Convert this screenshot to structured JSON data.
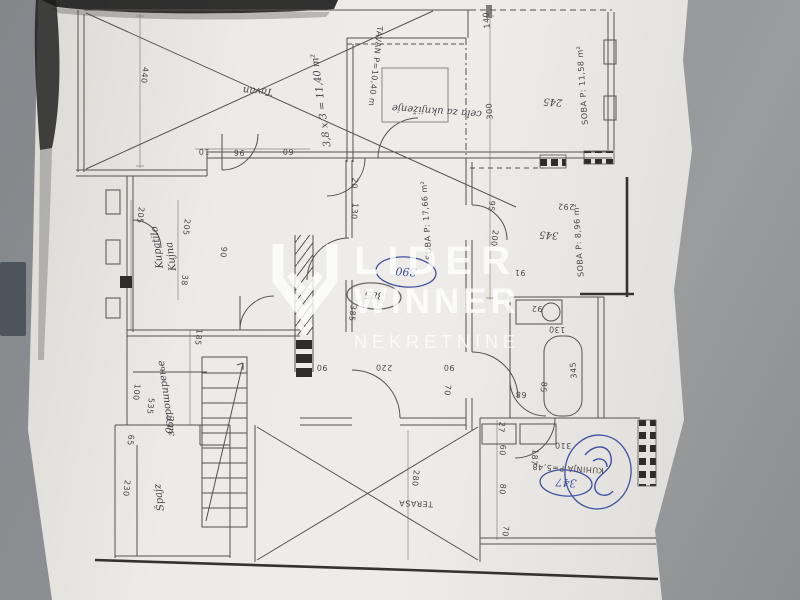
{
  "watermark": {
    "line1": "LIDER",
    "line2": "WINNER",
    "line3": "NEKRETNINE",
    "color": "#ffffff",
    "logo": "shield-chevron-icon"
  },
  "photo": {
    "background_color": "#8f9193",
    "paper_color": "#edebe7",
    "ink_color": "#4b4a45",
    "pen_color": "#3f51a2"
  },
  "plan": {
    "labels": [
      {
        "n": "dim-440",
        "t": "440",
        "x": 142,
        "y": 75,
        "r": 96,
        "cls": "d"
      },
      {
        "n": "hand-tavan",
        "t": "Tavan",
        "x": 258,
        "y": 88,
        "r": 184,
        "cls": "h",
        "s": 14
      },
      {
        "n": "hand-area-note",
        "t": "3,8 x 3 = 11,40 m²",
        "x": 324,
        "y": 100,
        "r": -98,
        "cls": "h",
        "s": 9
      },
      {
        "n": "room-tavan-label",
        "t": "TAVAN P=10,40 m",
        "x": 373,
        "y": 66,
        "r": 96,
        "cls": "d"
      },
      {
        "n": "dim-10",
        "t": "10",
        "x": 204,
        "y": 149,
        "r": 182,
        "cls": "d"
      },
      {
        "n": "dim-96",
        "t": "96",
        "x": 239,
        "y": 150,
        "r": 182,
        "cls": "d"
      },
      {
        "n": "dim-60a",
        "t": "60",
        "x": 288,
        "y": 149,
        "r": 182,
        "cls": "d"
      },
      {
        "n": "dim-140",
        "t": "140",
        "x": 489,
        "y": 20,
        "r": -94,
        "cls": "d"
      },
      {
        "n": "room-soba-1158",
        "t": "SOBA P: 11,58 m²",
        "x": 585,
        "y": 85,
        "r": -94,
        "cls": "d",
        "s": 8.5
      },
      {
        "n": "hand-uknjizenje",
        "t": "cela za uknjiženje",
        "x": 437,
        "y": 108,
        "r": 184,
        "cls": "h",
        "s": 11
      },
      {
        "n": "dim-300",
        "t": "300",
        "x": 492,
        "y": 111,
        "r": -94,
        "cls": "d"
      },
      {
        "n": "hand-245",
        "t": "245",
        "x": 553,
        "y": 99,
        "r": 184,
        "cls": "h",
        "s": 9
      },
      {
        "n": "dim-205a",
        "t": "205",
        "x": 138,
        "y": 215,
        "r": 96,
        "cls": "d"
      },
      {
        "n": "dim-205b",
        "t": "205",
        "x": 184,
        "y": 227,
        "r": 96,
        "cls": "d"
      },
      {
        "n": "dim-38",
        "t": "38",
        "x": 182,
        "y": 280,
        "r": 96,
        "cls": "d"
      },
      {
        "n": "dim-90a",
        "t": "90",
        "x": 221,
        "y": 252,
        "r": 96,
        "cls": "d"
      },
      {
        "n": "hand-kupatilo",
        "t": "Kupatilo",
        "x": 160,
        "y": 247,
        "r": -98,
        "cls": "h",
        "s": 9
      },
      {
        "n": "hand-kujna",
        "t": "Kujna",
        "x": 174,
        "y": 256,
        "r": -98,
        "cls": "h",
        "s": 9
      },
      {
        "n": "dim-20",
        "t": "20",
        "x": 352,
        "y": 183,
        "r": 96,
        "cls": "d"
      },
      {
        "n": "dim-130a",
        "t": "130",
        "x": 352,
        "y": 211,
        "r": 96,
        "cls": "d"
      },
      {
        "n": "dim-385",
        "t": "385",
        "x": 350,
        "y": 313,
        "r": 96,
        "cls": "d"
      },
      {
        "n": "room-soba-1766",
        "t": "SOBA P: 17,66 m²",
        "x": 429,
        "y": 220,
        "r": -94,
        "cls": "d",
        "s": 8.5
      },
      {
        "n": "dim-292",
        "t": "292",
        "x": 566,
        "y": 204,
        "r": 182,
        "cls": "d"
      },
      {
        "n": "dim-95",
        "t": "95",
        "x": 489,
        "y": 206,
        "r": 96,
        "cls": "d"
      },
      {
        "n": "dim-200",
        "t": "200",
        "x": 492,
        "y": 238,
        "r": 96,
        "cls": "d"
      },
      {
        "n": "room-soba-896",
        "t": "SOBA P: 8,96 m²",
        "x": 581,
        "y": 240,
        "r": -94,
        "cls": "d",
        "s": 8.5
      },
      {
        "n": "hand-345a",
        "t": "345",
        "x": 549,
        "y": 232,
        "r": 184,
        "cls": "h",
        "s": 9
      },
      {
        "n": "dim-91",
        "t": "91",
        "x": 520,
        "y": 270,
        "r": 182,
        "cls": "d"
      },
      {
        "n": "dim-92",
        "t": "92",
        "x": 537,
        "y": 306,
        "r": 182,
        "cls": "d"
      },
      {
        "n": "dim-130b",
        "t": "130",
        "x": 557,
        "y": 327,
        "r": 182,
        "cls": "d"
      },
      {
        "n": "dim-345b",
        "t": "345",
        "x": 576,
        "y": 370,
        "r": -94,
        "cls": "d"
      },
      {
        "n": "dim-85",
        "t": "85",
        "x": 541,
        "y": 387,
        "r": 96,
        "cls": "d"
      },
      {
        "n": "dim-68",
        "t": "68",
        "x": 521,
        "y": 392,
        "r": 182,
        "cls": "d"
      },
      {
        "n": "dim-185",
        "t": "185",
        "x": 196,
        "y": 337,
        "r": 96,
        "cls": "d"
      },
      {
        "n": "dim-100",
        "t": "100",
        "x": 134,
        "y": 392,
        "r": 96,
        "cls": "d"
      },
      {
        "n": "dim-535",
        "t": "535",
        "x": 148,
        "y": 406,
        "r": 96,
        "cls": "d"
      },
      {
        "n": "hand-prosirenje",
        "t": "за проширење",
        "x": 169,
        "y": 398,
        "r": -98,
        "cls": "h",
        "s": 9
      },
      {
        "n": "hand-390",
        "t": "390",
        "x": 166,
        "y": 424,
        "r": 96,
        "cls": "h",
        "s": 9
      },
      {
        "n": "hand-spajz",
        "t": "Špajz",
        "x": 162,
        "y": 497,
        "r": -98,
        "cls": "h",
        "s": 12
      },
      {
        "n": "dim-230",
        "t": "230",
        "x": 124,
        "y": 488,
        "r": 96,
        "cls": "d"
      },
      {
        "n": "dim-65",
        "t": "65",
        "x": 128,
        "y": 440,
        "r": 96,
        "cls": "d"
      },
      {
        "n": "room-terasa",
        "t": "TERASA",
        "x": 416,
        "y": 501,
        "r": 182,
        "cls": "d",
        "s": 9.5
      },
      {
        "n": "dim-280",
        "t": "280",
        "x": 413,
        "y": 478,
        "r": 96,
        "cls": "d"
      },
      {
        "n": "dim-220",
        "t": "220",
        "x": 384,
        "y": 365,
        "r": 182,
        "cls": "d"
      },
      {
        "n": "dim-90b",
        "t": "90",
        "x": 322,
        "y": 365,
        "r": 182,
        "cls": "d"
      },
      {
        "n": "dim-90c",
        "t": "90",
        "x": 449,
        "y": 365,
        "r": 182,
        "cls": "d"
      },
      {
        "n": "dim-70a",
        "t": "70",
        "x": 445,
        "y": 390,
        "r": 96,
        "cls": "d"
      },
      {
        "n": "room-kuhinja",
        "t": "KUHINJA P=5,48",
        "x": 568,
        "y": 466,
        "r": 183,
        "cls": "d",
        "s": 8.5
      },
      {
        "n": "dim-187",
        "t": "187",
        "x": 532,
        "y": 457,
        "r": 96,
        "cls": "d"
      },
      {
        "n": "dim-60b",
        "t": "60",
        "x": 500,
        "y": 450,
        "r": 96,
        "cls": "d"
      },
      {
        "n": "dim-27",
        "t": "27",
        "x": 499,
        "y": 427,
        "r": 96,
        "cls": "d"
      },
      {
        "n": "dim-80",
        "t": "80",
        "x": 500,
        "y": 489,
        "r": 96,
        "cls": "d"
      },
      {
        "n": "dim-70b",
        "t": "70",
        "x": 503,
        "y": 531,
        "r": 96,
        "cls": "d"
      },
      {
        "n": "dim-310",
        "t": "310",
        "x": 563,
        "y": 443,
        "r": 182,
        "cls": "d"
      }
    ],
    "circled": [
      {
        "n": "circled-390-blue-pen",
        "t": "390",
        "x": 406,
        "y": 272,
        "r": 184,
        "rx": 30,
        "ry": 15,
        "cls": "hb"
      },
      {
        "n": "circled-385-pencil",
        "t": "385",
        "x": 374,
        "y": 296,
        "r": 184,
        "rx": 27,
        "ry": 13,
        "cls": "h"
      },
      {
        "n": "circled-347-blue-pen",
        "t": "347",
        "x": 566,
        "y": 483,
        "r": 184,
        "rx": 26,
        "ry": 13,
        "cls": "hb"
      },
      {
        "n": "circled-scribble-blue-pen",
        "t": "",
        "x": 598,
        "y": 472,
        "r": 8,
        "rx": 33,
        "ry": 37,
        "cls": "hb"
      }
    ]
  }
}
